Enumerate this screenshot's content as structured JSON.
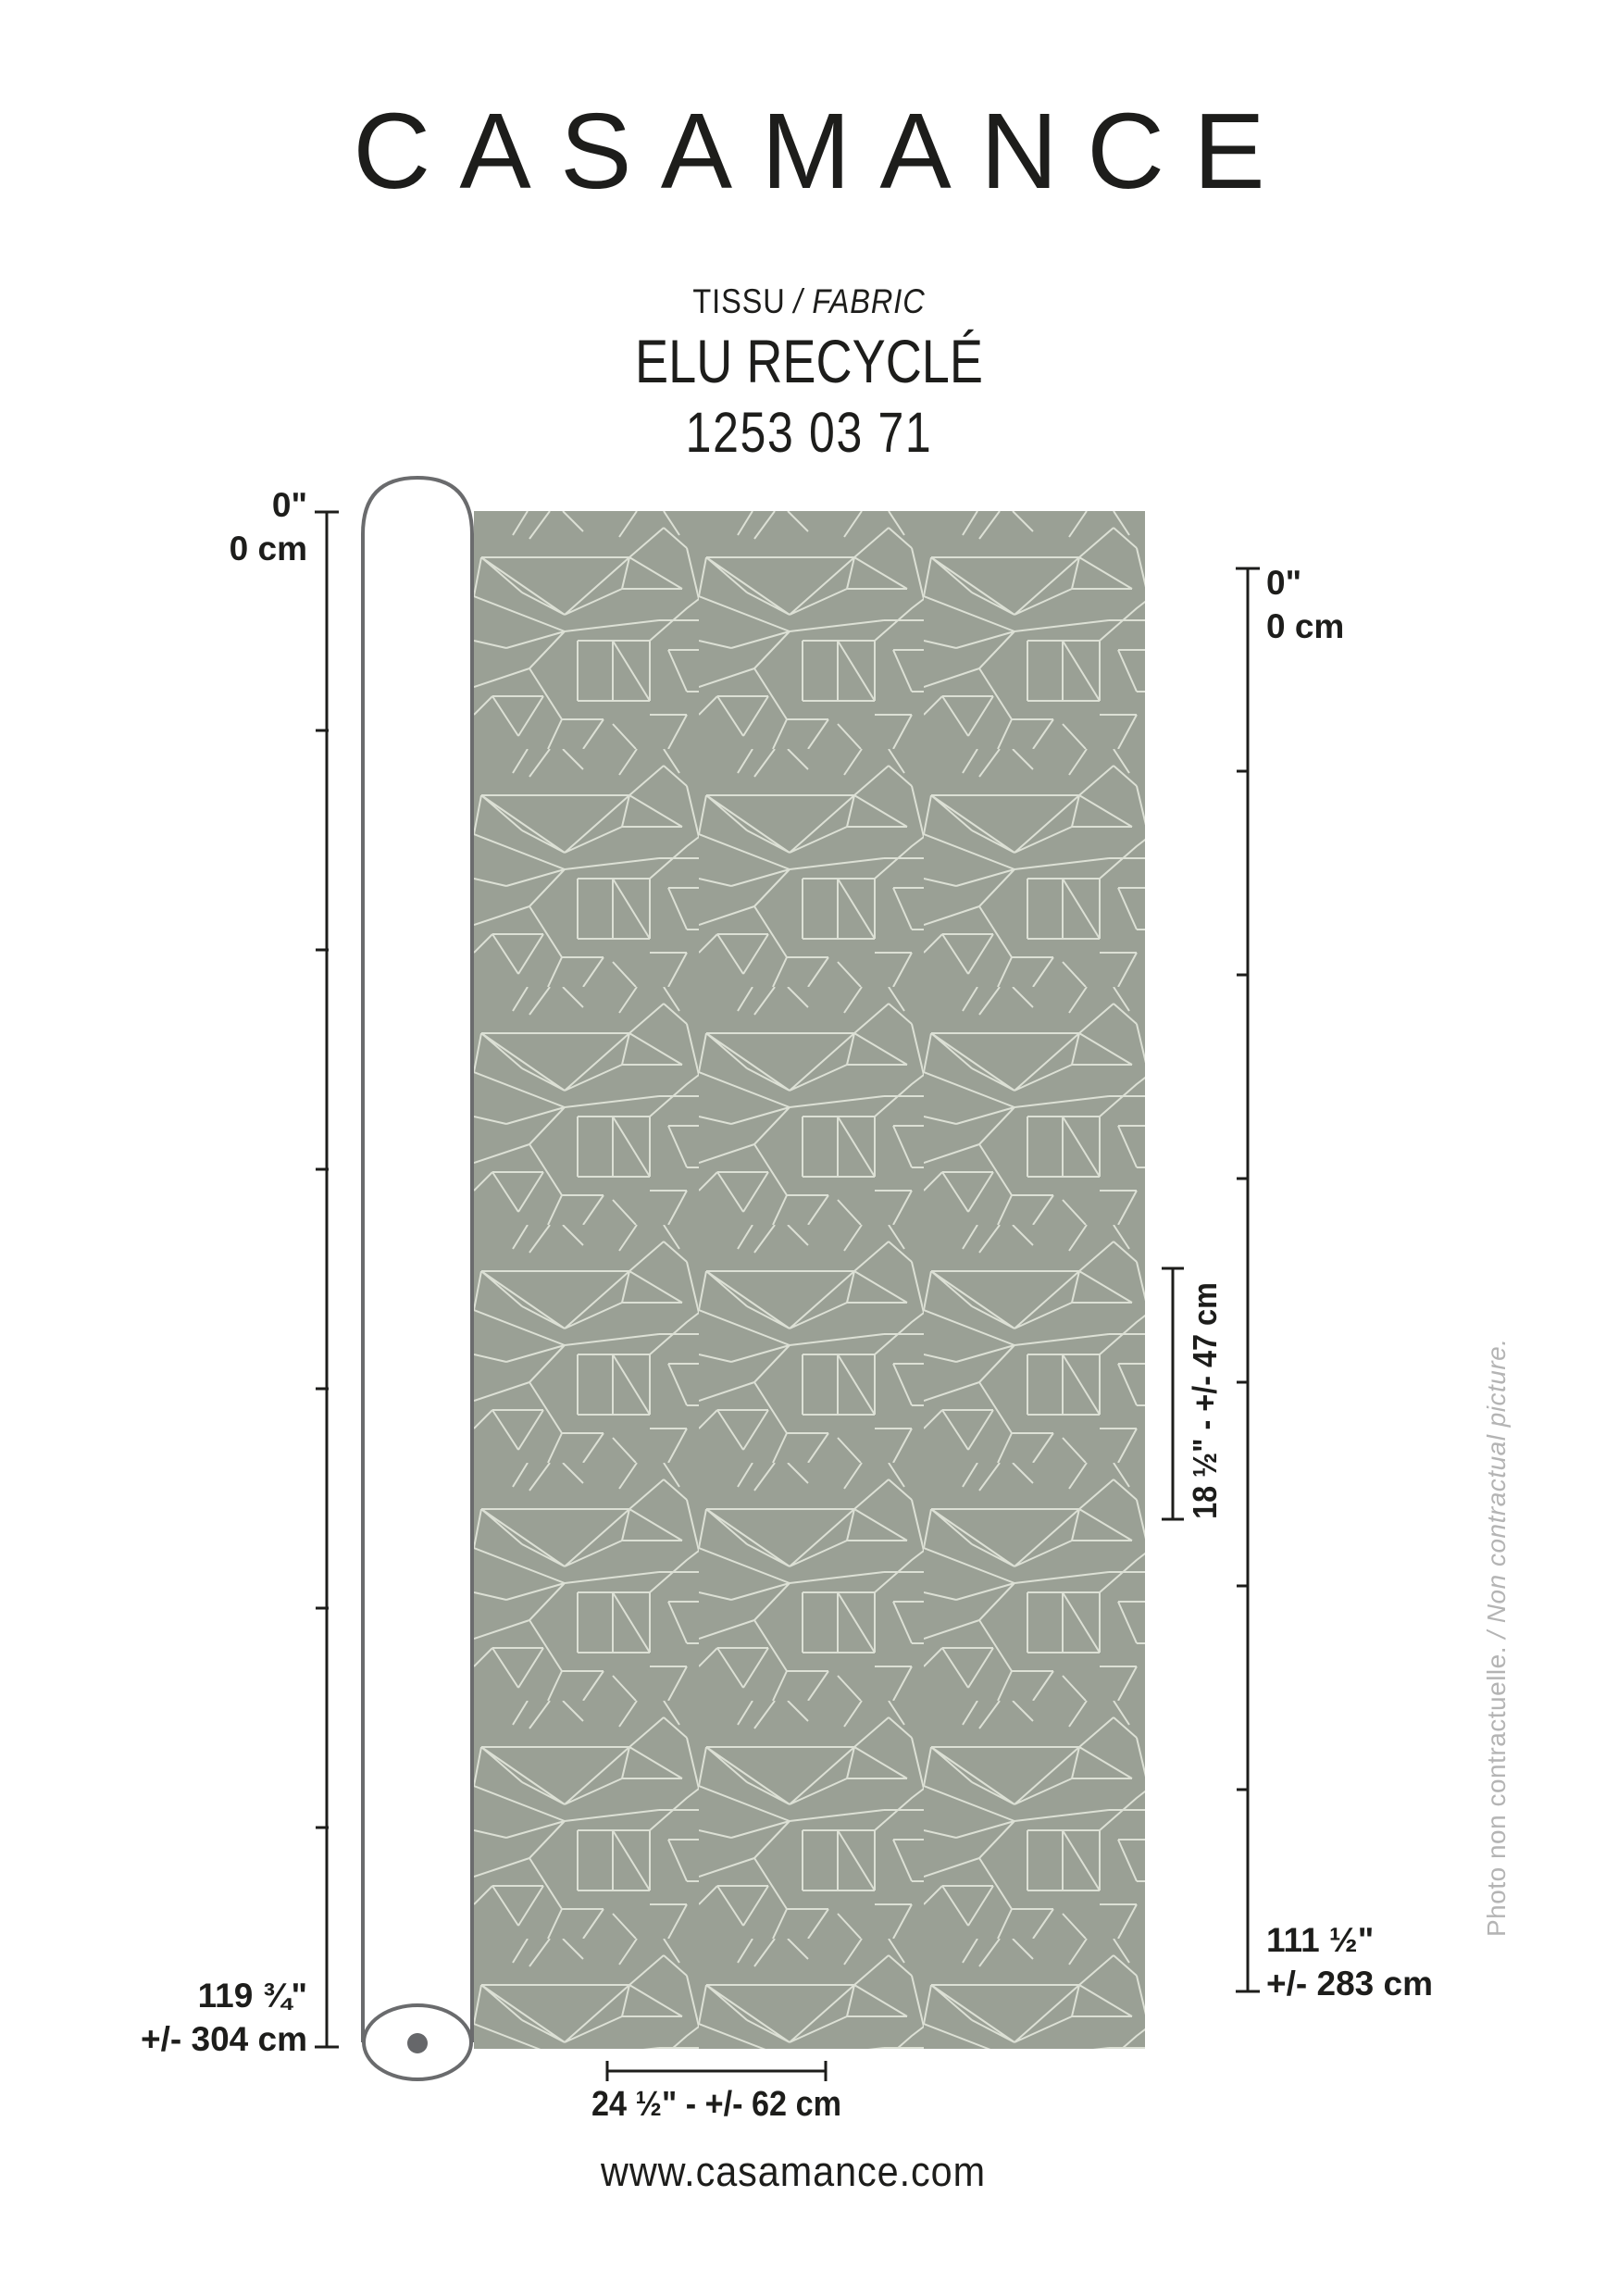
{
  "brand": "CASAMANCE",
  "subtitle": {
    "fr": "TISSU",
    "en_italic": "/ FABRIC"
  },
  "product": {
    "name": "ELU RECYCLÉ",
    "reference": "1253 03 71"
  },
  "measurements": {
    "left_top_in": "0\"",
    "left_top_cm": "0 cm",
    "left_bottom_in": "119 ¾\"",
    "left_bottom_cm": "+/- 304 cm",
    "right_top_in": "0\"",
    "right_top_cm": "0 cm",
    "right_bottom_in": "111 ½\"",
    "right_bottom_cm": "+/- 283 cm",
    "vertical_repeat": "18 ½\" - +/- 47 cm",
    "horizontal_repeat": "24 ½\" - +/- 62 cm"
  },
  "note": {
    "fr": "Photo non contractuelle.",
    "en_italic": "/ Non contractual picture."
  },
  "website": "www.casamance.com",
  "colors": {
    "ink": "#1d1d1b",
    "outline_gray": "#6a6b6d",
    "fabric_base": "#9aa095",
    "fabric_line": "#dce0d5",
    "note_gray": "#b4b4b4"
  }
}
